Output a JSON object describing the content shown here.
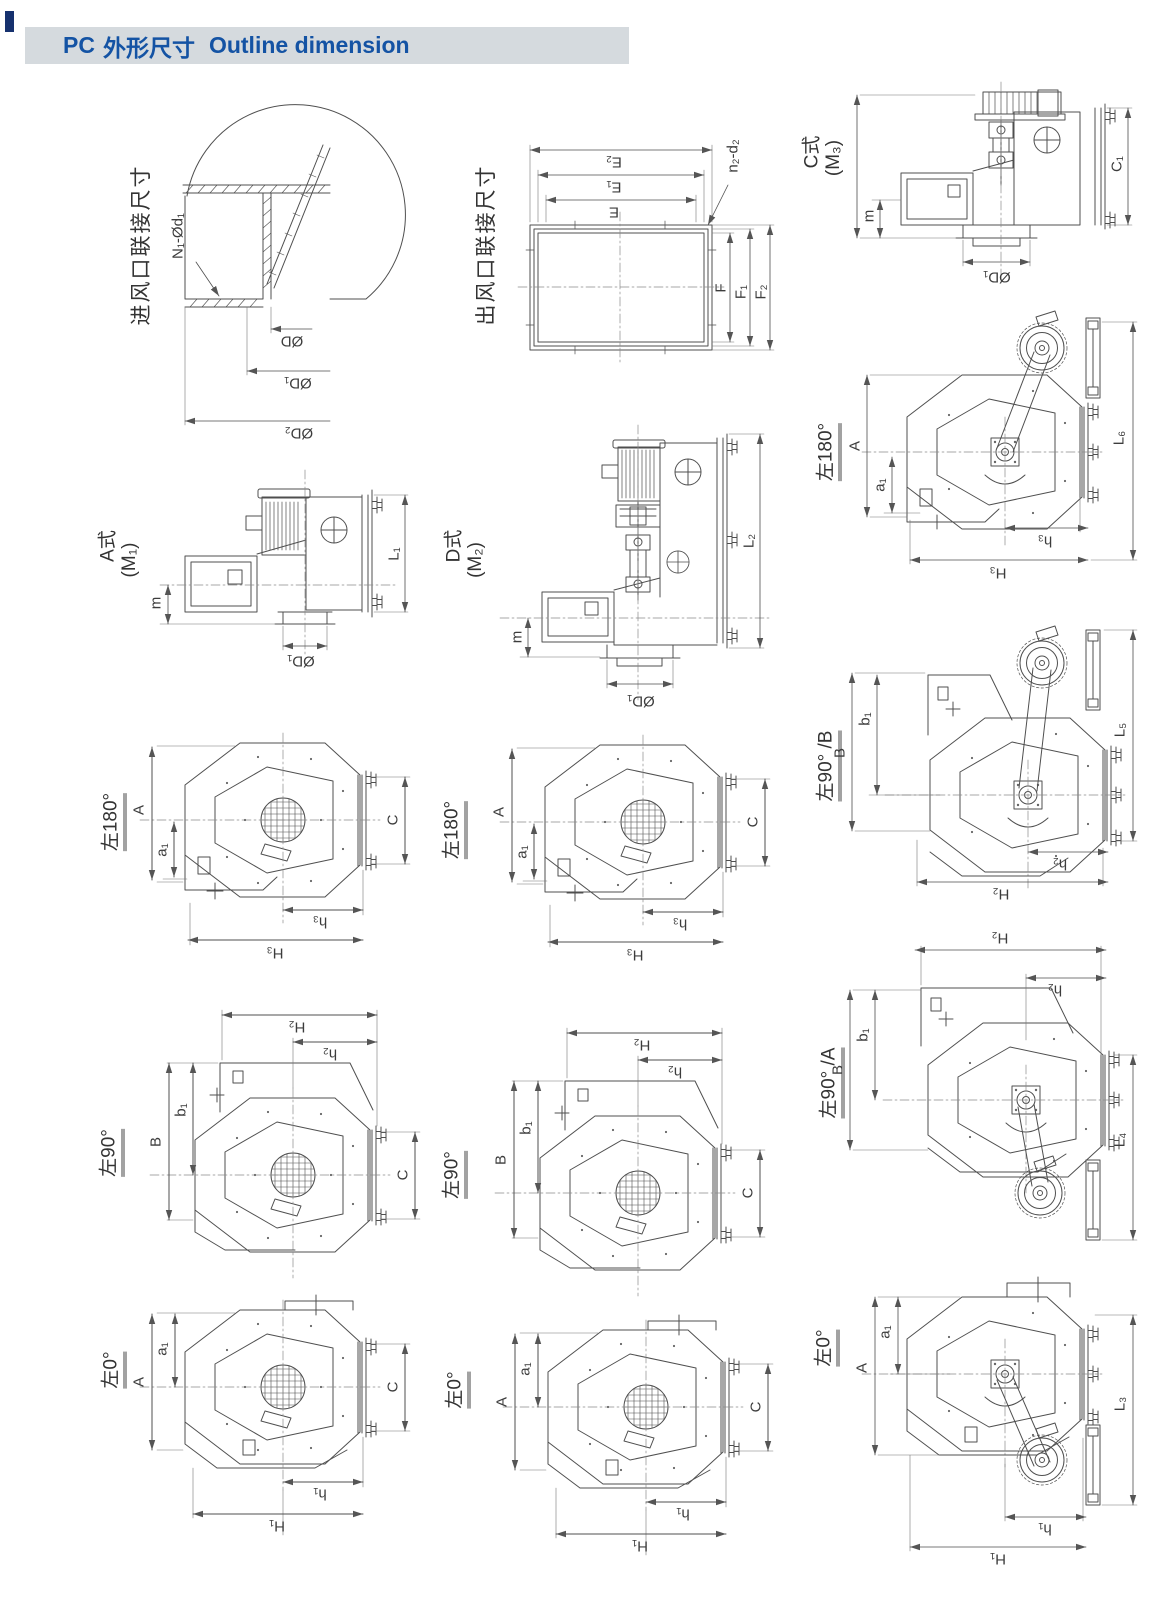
{
  "header": {
    "code": "PC",
    "title_zh": "外形尺寸",
    "title_en": "Outline dimension"
  },
  "colors": {
    "header_bg": "#d5dade",
    "header_text": "#1453a4",
    "line": "#4f4f4f",
    "edge_mark": "#16316e"
  },
  "diagrams": {
    "inlet": {
      "title": "进风口联接尺寸",
      "dims": [
        "N₁-Ød₁",
        "ØD",
        "ØD₁",
        "ØD₂"
      ]
    },
    "outlet": {
      "title": "出风口联接尺寸",
      "dims": [
        "E₂",
        "E₁",
        "E",
        "n₂-d₂",
        "F",
        "F₁",
        "F₂"
      ]
    },
    "typeC": {
      "title": "C式",
      "sub": "(M₃)",
      "dims": [
        "m",
        "ØD₁",
        "C₁"
      ]
    },
    "typeA": {
      "title": "A式",
      "sub": "(M₁)",
      "dims": [
        "m",
        "ØD₁",
        "L₁"
      ]
    },
    "typeD": {
      "title": "D式",
      "sub": "(M₂)",
      "dims": [
        "m",
        "ØD₁",
        "L₂"
      ]
    },
    "belt180": {
      "title": "左180°",
      "dims": [
        "A",
        "a₁",
        "h₃",
        "H₃",
        "L₆"
      ]
    },
    "front180L": {
      "title": "左180°",
      "dims": [
        "A",
        "a₁",
        "C",
        "h₃",
        "H₃"
      ]
    },
    "front180M": {
      "title": "左180°",
      "dims": [
        "A",
        "a₁",
        "C",
        "h₃",
        "H₃"
      ]
    },
    "front90L": {
      "title": "左90°",
      "dims": [
        "H₂",
        "h₂",
        "B",
        "b₁",
        "C"
      ]
    },
    "front90M": {
      "title": "左90°",
      "dims": [
        "H₂",
        "h₂",
        "B",
        "b₁",
        "C"
      ]
    },
    "belt90B": {
      "title": "左90° /B",
      "dims": [
        "B",
        "b₁",
        "h₂",
        "H₂",
        "L₅"
      ]
    },
    "belt90A": {
      "title": "左90° /A",
      "dims": [
        "H₂",
        "h₂",
        "B",
        "b₁",
        "L₄"
      ]
    },
    "front0L": {
      "title": "左0°",
      "dims": [
        "A",
        "a₁",
        "C",
        "h₁",
        "H₁"
      ]
    },
    "front0M": {
      "title": "左0°",
      "dims": [
        "A",
        "a₁",
        "C",
        "h₁",
        "H₁"
      ]
    },
    "belt0": {
      "title": "左0°",
      "dims": [
        "a₁",
        "A",
        "h₁",
        "H₁",
        "L₃"
      ]
    }
  }
}
